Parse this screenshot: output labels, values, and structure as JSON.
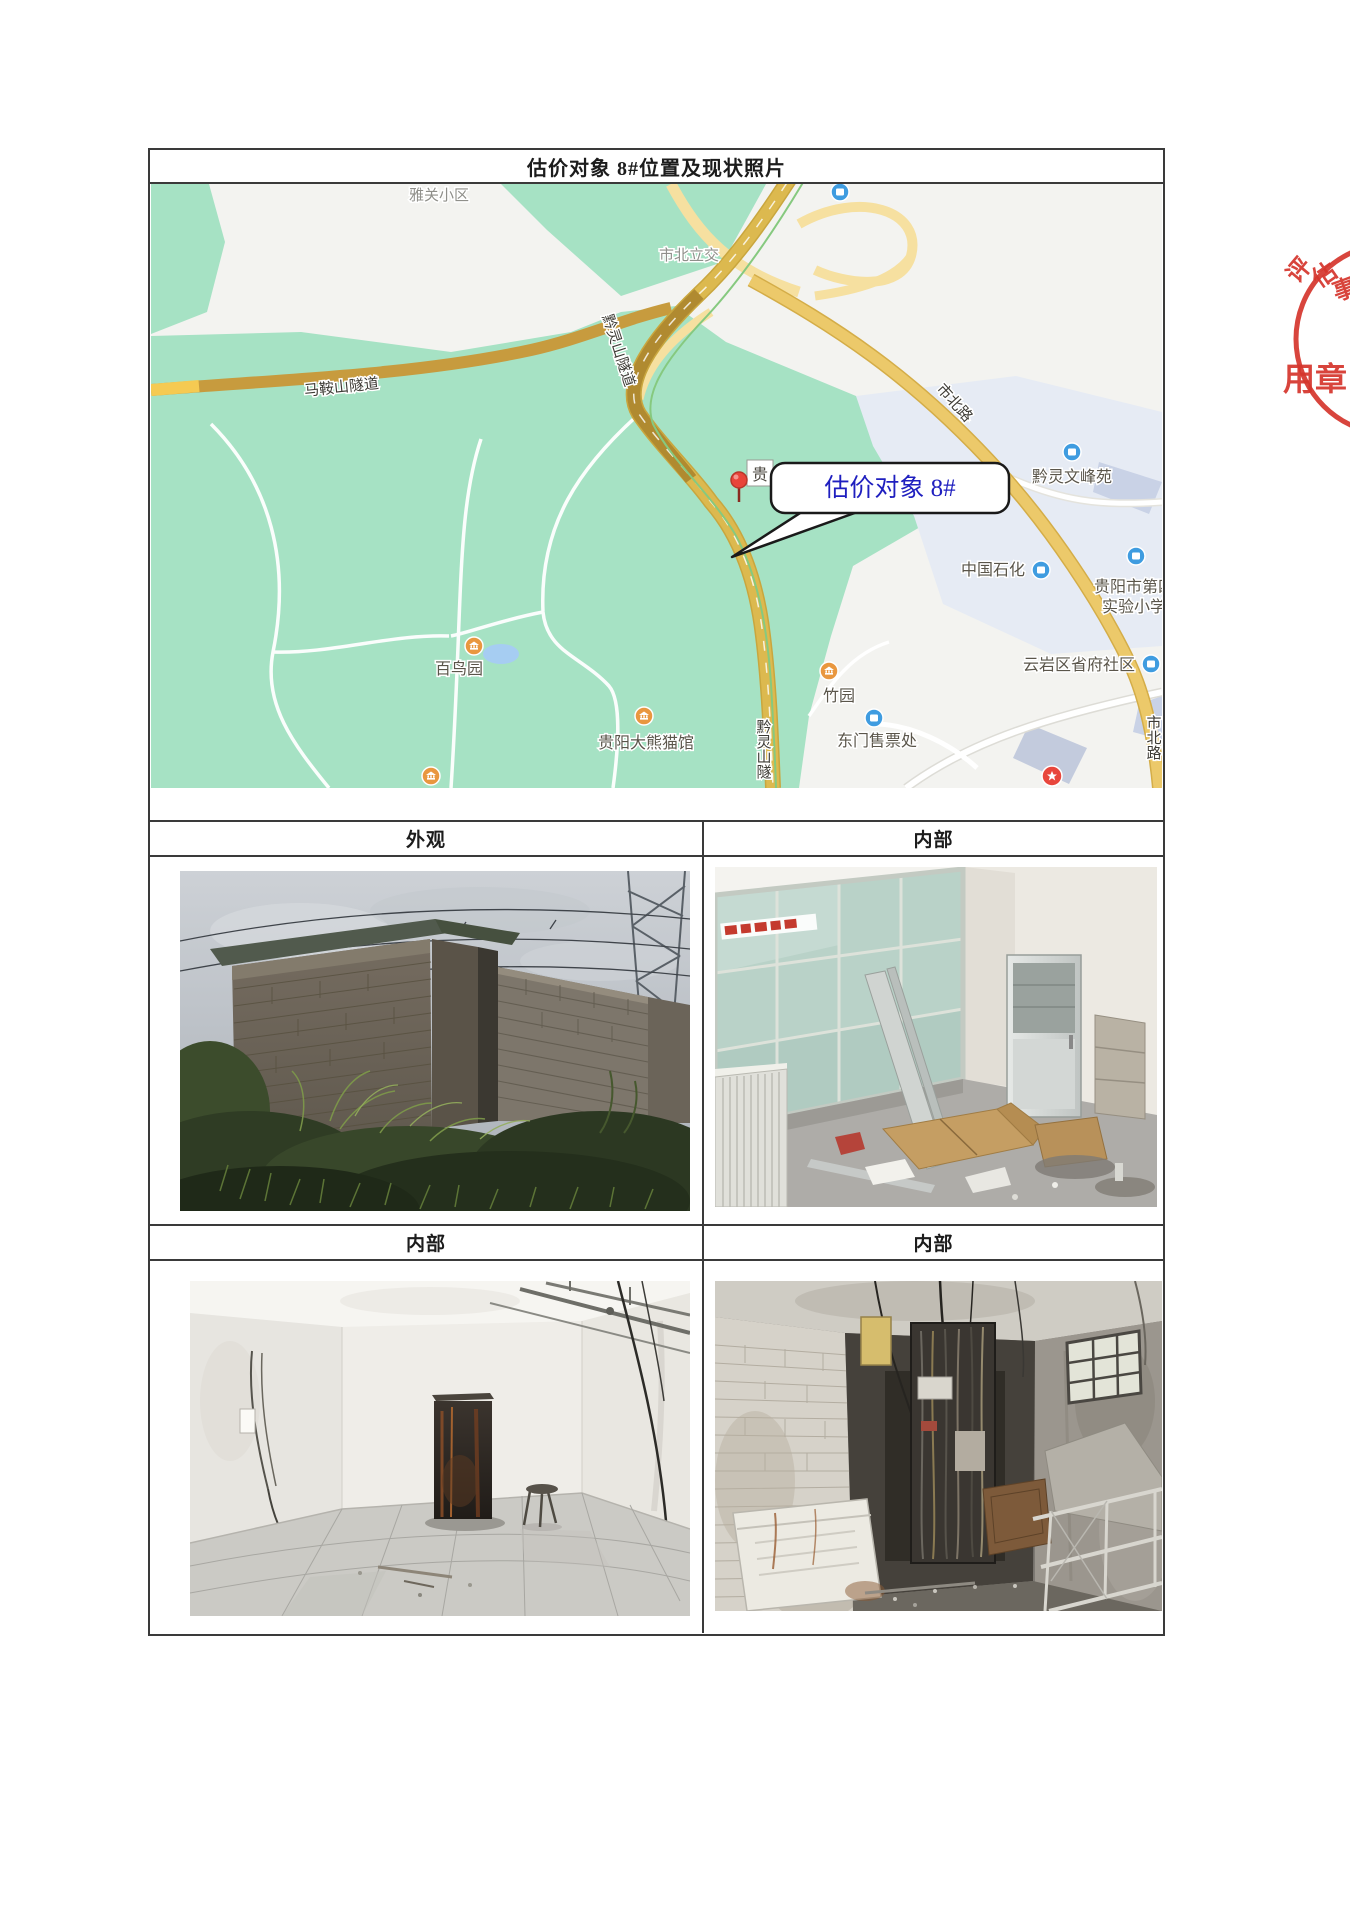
{
  "colors": {
    "accent_blue": "#1f1fbf",
    "seal_red": "#d5352c",
    "park_green": "#a6e2c4",
    "road_gold": "#dcb94f",
    "poi_orange": "#e9973f",
    "poi_blue": "#3f9ce0"
  },
  "document": {
    "title": "估价对象 8#位置及现状照片",
    "headers": [
      "外观",
      "内部",
      "内部",
      "内部"
    ]
  },
  "map": {
    "callout_label": "估价对象 8#",
    "pin_label": "贵",
    "labels": {
      "district_top": "雅关小区",
      "interchange": "市北立交",
      "maanshan_tunnel": "马鞍山隧道",
      "qianling_tunnel": "黔灵山隧道",
      "qianling_tunnel_short": "黔灵山隧",
      "shibei_road_upper": "市北路",
      "shibei_road_lower": "市北路",
      "wenfeng_yuan": "黔灵文峰苑",
      "sinopec": "中国石化",
      "school_line1": "贵阳市第四",
      "school_line2": "实验小学",
      "community": "云岩区省府社区",
      "bird_garden": "百鸟园",
      "panda_house": "贵阳大熊猫馆",
      "bamboo_garden": "竹园",
      "east_gate_ticket": "东门售票处"
    }
  },
  "seal": {
    "ring_chars": [
      "评",
      "估",
      "事"
    ],
    "center_text": "用章"
  }
}
